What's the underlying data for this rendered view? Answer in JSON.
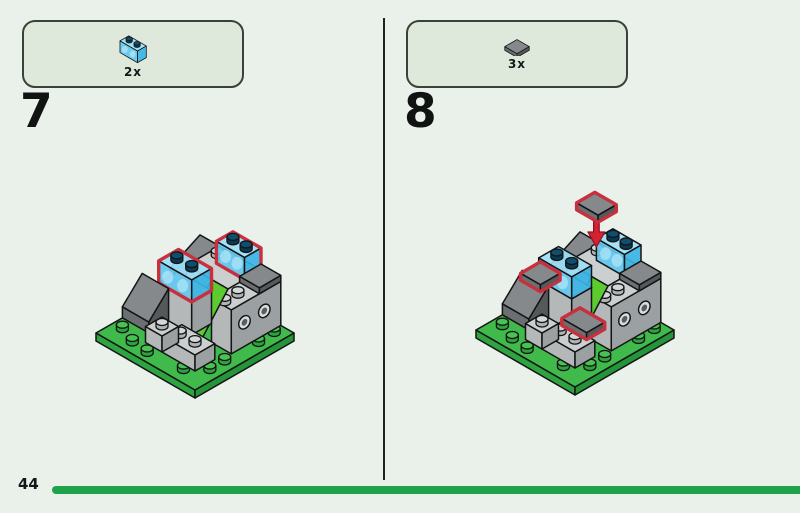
{
  "steps": [
    {
      "number": "7",
      "part_count": "2x",
      "part_name": "transparent-blue-brick-1x2"
    },
    {
      "number": "8",
      "part_count": "3x",
      "part_name": "dark-gray-tile-1x1"
    }
  ],
  "footer": {
    "page_number": "44"
  },
  "colors": {
    "background": "#e9f1ea",
    "callout_fill": "#dee8db",
    "callout_border": "#39423a",
    "progress_green": "#1fa34a",
    "highlight_red": "#c8303e",
    "baseplate_green": "#3fba4b",
    "transparent_blue": "#62c8ef",
    "arrow_red": "#d42230"
  }
}
